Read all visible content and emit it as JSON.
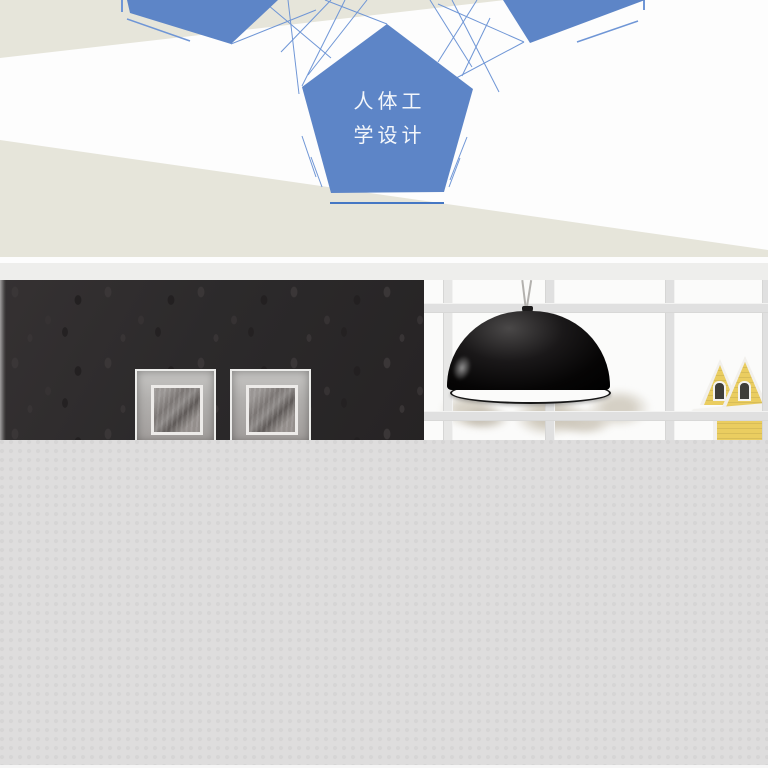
{
  "hero": {
    "badge": {
      "line1": "人体工",
      "line2": "学设计"
    }
  },
  "colors": {
    "pentagon-blue": "#5d85c7",
    "beige": "#e6e5da",
    "line-blue": "#6f96d6",
    "underline-blue": "#4577c4",
    "strip-gray": "#eeeeec",
    "wall-dark": "#2c2a2b",
    "page-gray": "#dedddd",
    "house-yellow": "#eacd60",
    "mullion-gray": "#e0e0e0"
  }
}
